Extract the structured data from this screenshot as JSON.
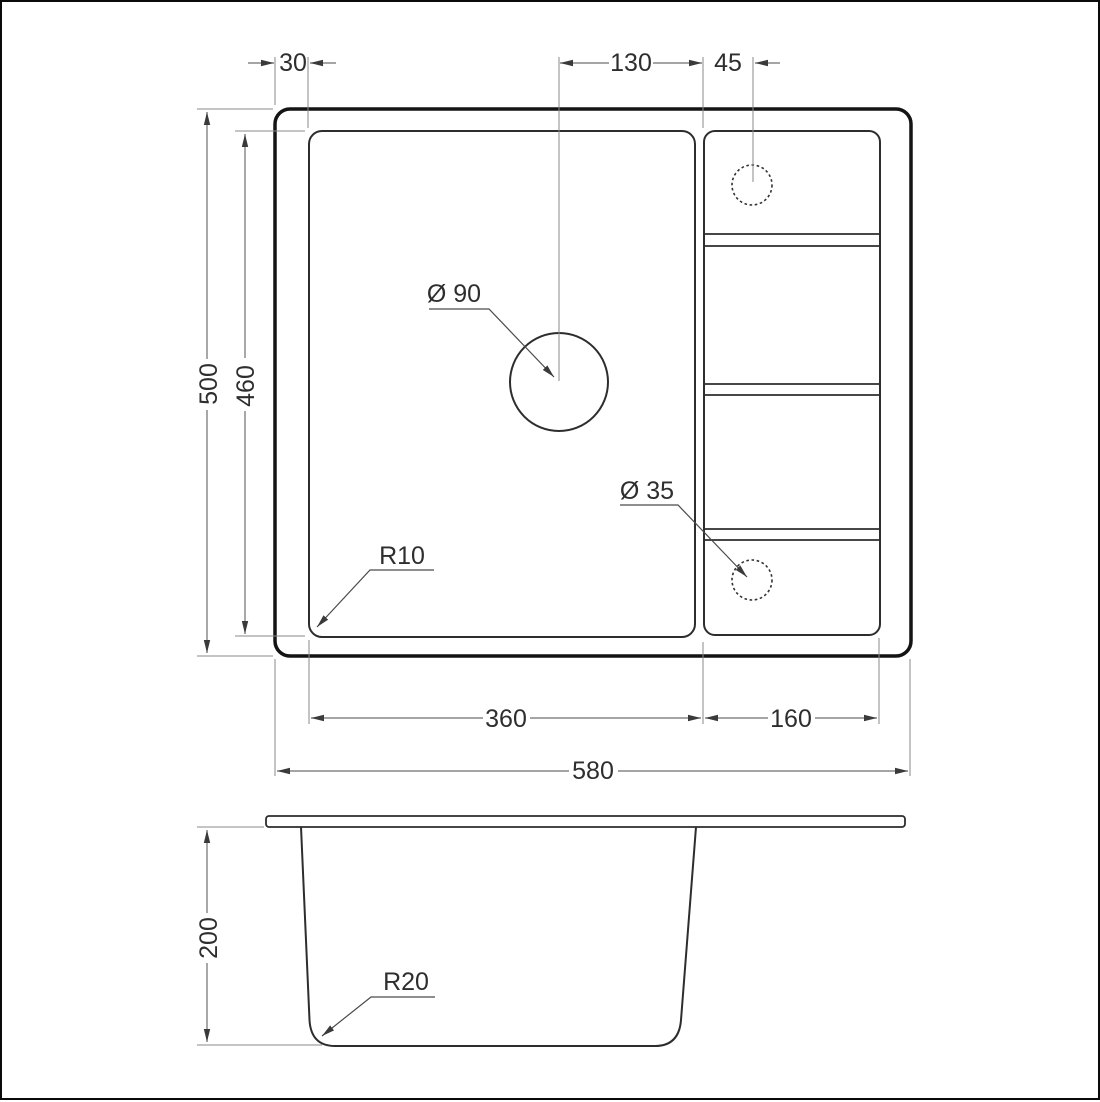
{
  "page": {
    "background_color": "#ffffff",
    "border_color": "#0a0a0a"
  },
  "drawing": {
    "kind": "technical dimensional drawing",
    "subject": "kitchen sink with drainer, plan view and sectional side view",
    "line_color": "#141414",
    "dimension_line_color": "#6f6f6f",
    "text_color": "#2e2e2e"
  },
  "top_view": {
    "dim_rim_to_bowl": "30",
    "dim_drain_to_divider": "130",
    "dim_divider_to_tap": "45",
    "dim_overall_depth": "500",
    "dim_bowl_depth": "460",
    "label_drain_diameter": "Ø 90",
    "label_tap_diameter": "Ø 35",
    "label_bowl_corner_radius": "R10",
    "dim_bowl_width": "360",
    "dim_drainer_width": "160",
    "dim_overall_width": "580"
  },
  "side_view": {
    "dim_bowl_height": "200",
    "label_bottom_corner_radius": "R20"
  }
}
